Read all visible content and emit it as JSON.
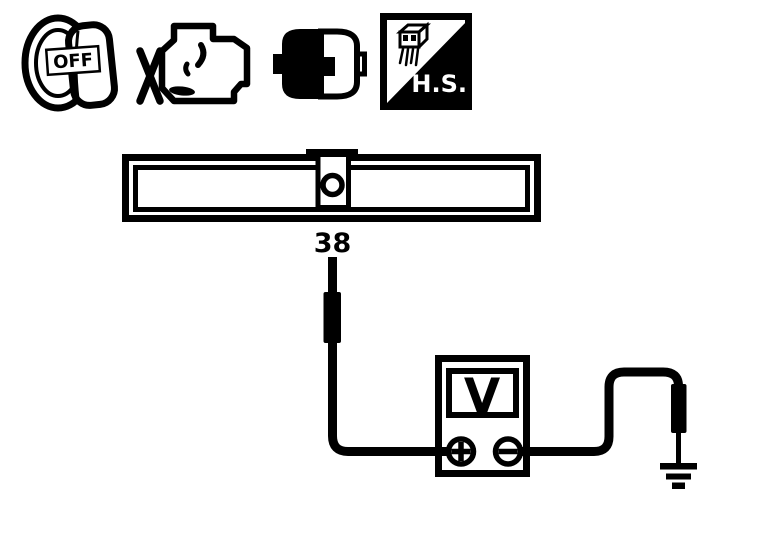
{
  "palette": {
    "ink": "#000000",
    "paper": "#ffffff"
  },
  "precondition_icons": [
    {
      "id": "ignition-switch-off-icon",
      "label": "OFF"
    },
    {
      "id": "engine-stopped-icon",
      "label": ""
    },
    {
      "id": "connector-disconnected-icon",
      "label": ""
    },
    {
      "id": "harness-side-connector-icon",
      "label": "H.S."
    }
  ],
  "connector_bar": {
    "terminal_label": "38"
  },
  "voltmeter": {
    "display_label": "V",
    "positive_terminal_symbol": "+",
    "negative_terminal_symbol": "−"
  },
  "ground": {
    "symbol_name": "earth-ground-symbol"
  }
}
